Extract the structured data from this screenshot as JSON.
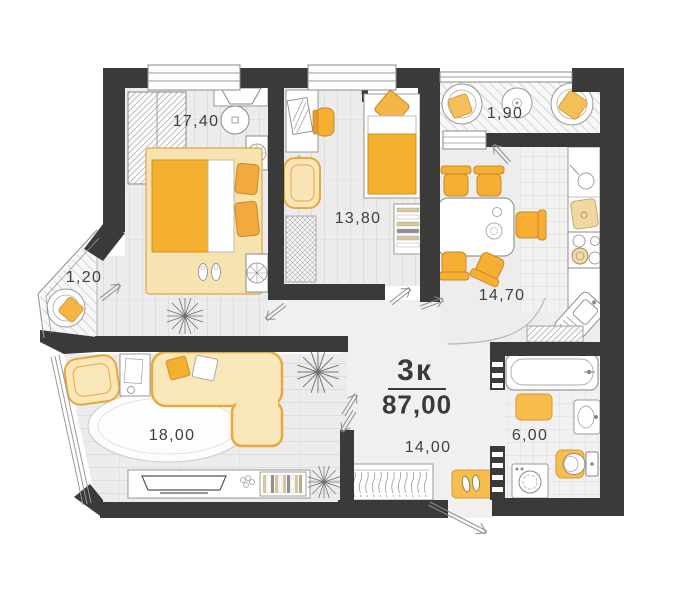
{
  "floor_plan": {
    "summary": {
      "rooms_label": "3к",
      "total_area": "87,00"
    },
    "rooms": [
      {
        "name": "bedroom-1",
        "area": "17,40",
        "furniture": [
          "wardrobe",
          "vanity-table",
          "vanity-stool",
          "double-bed",
          "bedside-cabinets",
          "slippers",
          "plant"
        ]
      },
      {
        "name": "bedroom-2",
        "area": "13,80",
        "furniture": [
          "desk",
          "desk-chair",
          "picture",
          "armchair",
          "rug",
          "single-bed",
          "shelf-unit"
        ]
      },
      {
        "name": "loggia-top",
        "area": "1,90",
        "furniture": [
          "round-chair",
          "coffee-table",
          "round-chair"
        ]
      },
      {
        "name": "kitchen-dining",
        "area": "14,70",
        "furniture": [
          "dining-table",
          "five-chairs",
          "kitchen-counter",
          "cutting-board",
          "stove",
          "sink"
        ]
      },
      {
        "name": "balcony-left",
        "area": "1,20",
        "furniture": [
          "round-chair"
        ]
      },
      {
        "name": "living-room",
        "area": "18,00",
        "furniture": [
          "corner-sofa",
          "armchair",
          "side-table",
          "oval-rug",
          "tv-stand",
          "tv",
          "bookshelf",
          "plants"
        ]
      },
      {
        "name": "hallway",
        "area": "14,00",
        "furniture": [
          "wardrobe",
          "entrance-mat"
        ]
      },
      {
        "name": "bathroom",
        "area": "6,00",
        "furniture": [
          "bathtub",
          "washbasin",
          "toilet",
          "washing-machine",
          "bath-mats",
          "cabinet"
        ]
      }
    ],
    "colors": {
      "wall": "#3a3a3a",
      "floor": "#ededed",
      "accent_orange": "#f5af2e",
      "accent_pale": "#f8e5b8",
      "mat_yellow": "#f7be4d",
      "text": "#3f3f3f",
      "background": "#ffffff"
    }
  }
}
